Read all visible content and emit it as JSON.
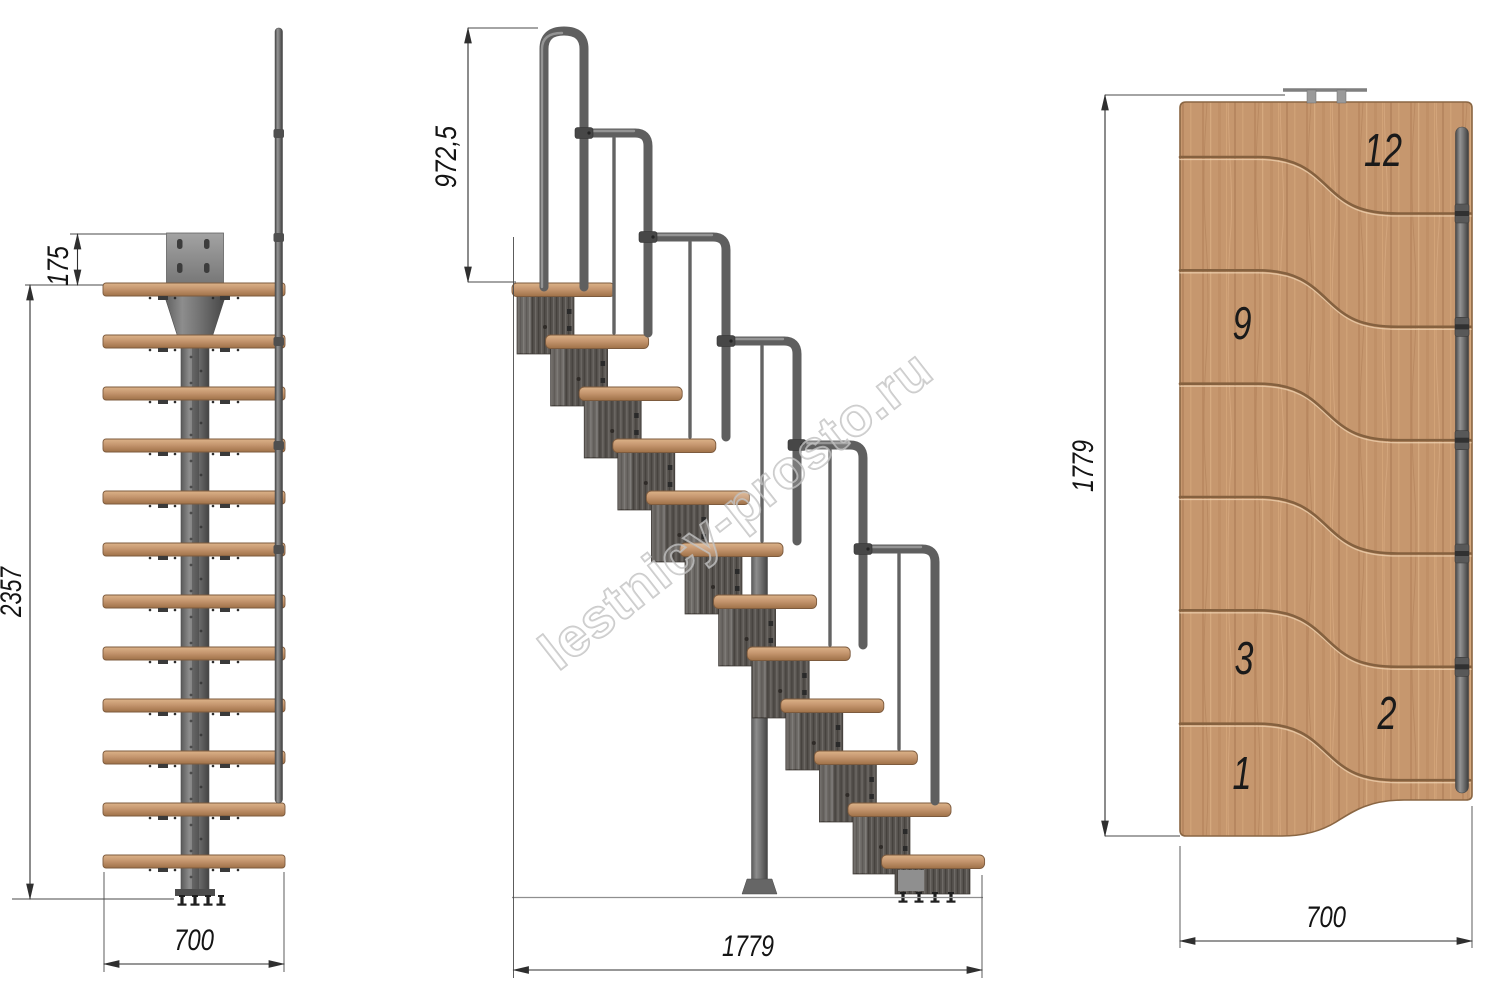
{
  "watermark": {
    "text": "lestnicy-prosto.ru"
  },
  "front_view": {
    "dim_plate_offset": "175",
    "dim_total_height": "2357",
    "dim_width": "700"
  },
  "side_view": {
    "dim_handrail_height": "972,5",
    "dim_total_run": "1779"
  },
  "plan_view": {
    "dim_total_run": "1779",
    "dim_width": "700",
    "step_labels": {
      "s12": "12",
      "s9": "9",
      "s3": "3",
      "s2": "2",
      "s1": "1"
    }
  },
  "colors": {
    "background": "#ffffff",
    "wood": "#c6976e",
    "wood_groove": "#85613f",
    "metal": "#6e6e6e",
    "module": "#57534f",
    "dimension": "#2f2f2f",
    "watermark_outline": "#bdbdbd"
  }
}
